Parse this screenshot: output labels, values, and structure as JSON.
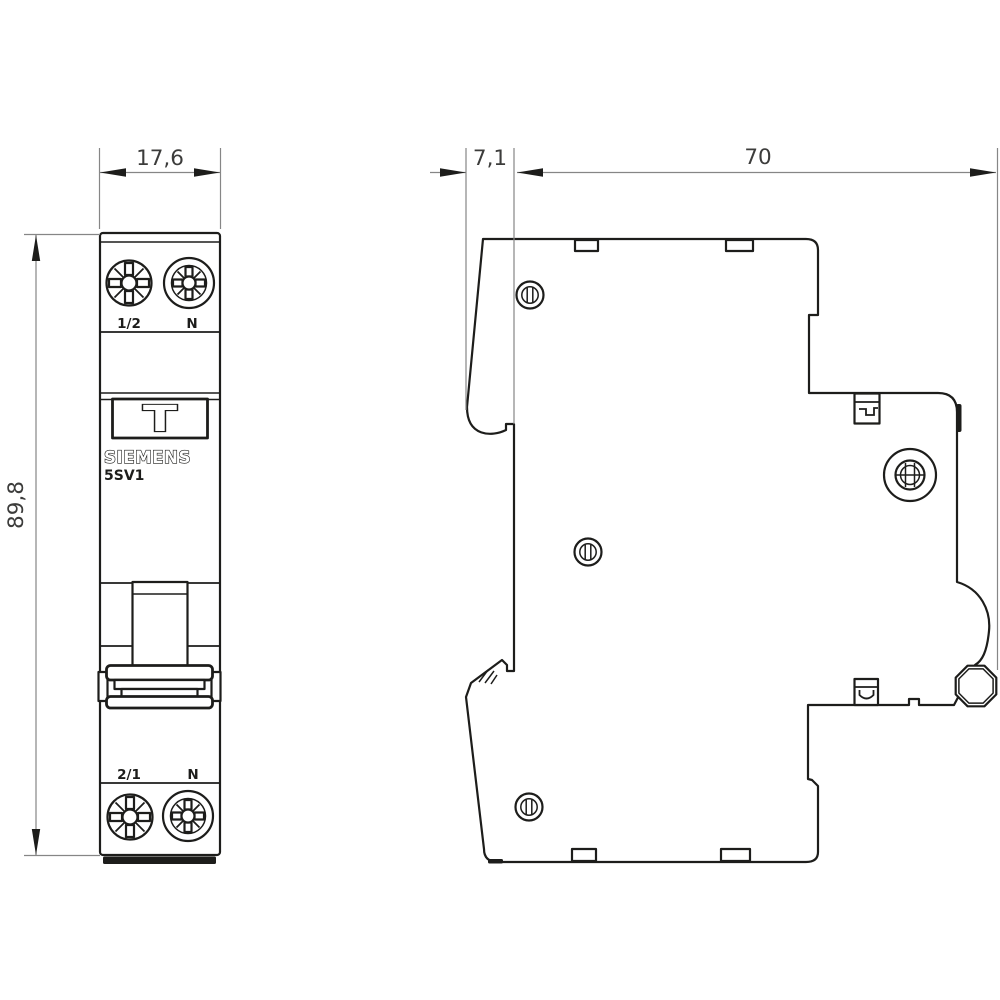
{
  "colors": {
    "line": "#1d1d1b",
    "dim_line": "#868686",
    "dim_text": "#3c3c3b",
    "background": "#ffffff"
  },
  "dimensions": {
    "front_width_mm": "17,6",
    "front_height_mm": "89,8",
    "side_front_depth_mm": "7,1",
    "side_total_depth_mm": "70"
  },
  "front_view": {
    "brand": "SIEMENS",
    "model": "5SV1",
    "test_button_label": "T",
    "terminals_top": {
      "left": "1/2",
      "right": "N"
    },
    "terminals_bottom": {
      "left": "2/1",
      "right": "N"
    }
  }
}
